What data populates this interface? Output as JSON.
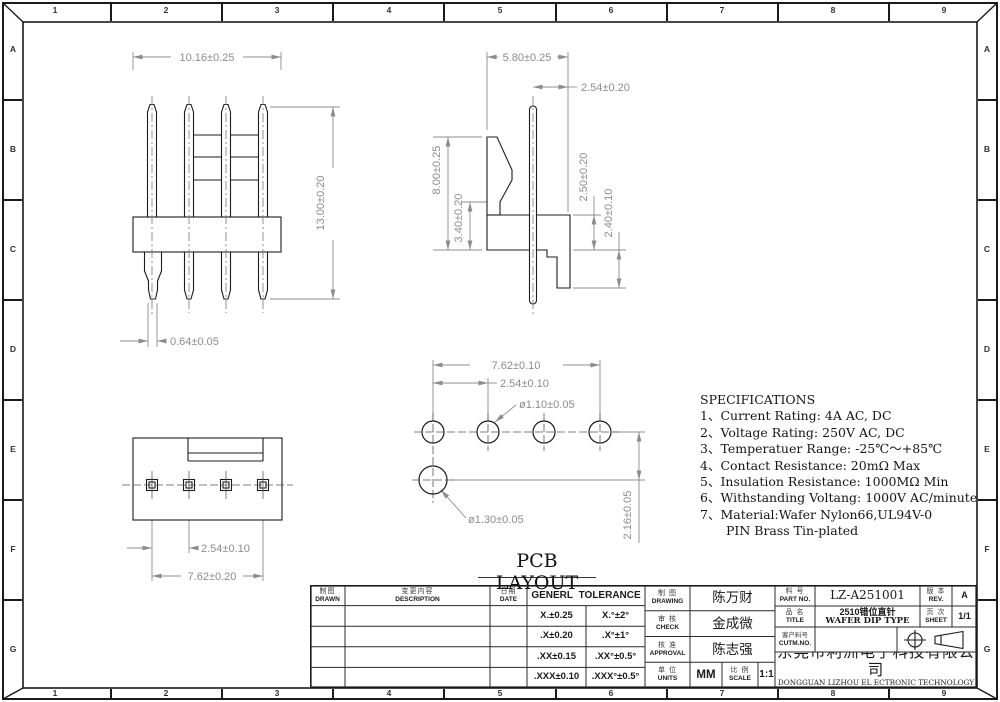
{
  "frame": {
    "cols": [
      "1",
      "2",
      "3",
      "4",
      "5",
      "6",
      "7",
      "8",
      "9"
    ],
    "rows": [
      "A",
      "B",
      "C",
      "D",
      "E",
      "F",
      "G"
    ]
  },
  "views": {
    "front": {
      "dim_width": "10.16±0.25",
      "dim_height": "13.00±0.20",
      "dim_pin_width": "0.64±0.05"
    },
    "side": {
      "dim_width": "5.80±0.25",
      "dim_pin_offset": "2.54±0.20",
      "dim_height": "8.00±0.25",
      "dim_body_height": "3.40±0.20",
      "dim_base_height": "2.50±0.20",
      "dim_foot_height": "2.40±0.10"
    },
    "bottom": {
      "dim_pitch": "2.54±0.10",
      "dim_span": "7.62±0.20"
    },
    "pcb": {
      "caption": "PCB LAYOUT",
      "dim_span": "7.62±0.10",
      "dim_pitch": "2.54±0.10",
      "dim_hole": "ø1.10±0.05",
      "dim_hole_offset": "ø1.30±0.05",
      "dim_row_offset": "2.16±0.05"
    }
  },
  "specs": {
    "title": "SPECIFICATIONS",
    "items": [
      "1、Current Rating: 4A AC, DC",
      "2、Voltage Rating: 250V AC, DC",
      "3、Temperatuer Range: -25℃～+85℃",
      "4、Contact Resistance: 20mΩ Max",
      "5、Insulation Resistance: 1000MΩ Min",
      "6、Withstanding Voltang: 1000V AC/minute",
      "7、Material:Wafer Nylon66,UL94V-0",
      "PIN Brass Tin-plated"
    ]
  },
  "title_block": {
    "drawn": {
      "cn": "制图",
      "en": "DRAWN"
    },
    "description": {
      "cn": "变更内容",
      "en": "DESCRIPTION"
    },
    "date": {
      "cn": "日期",
      "en": "DATE"
    },
    "tolerance": {
      "title": "GENERL TOLERANCE",
      "rows": [
        [
          "X.±0.25",
          "X.°±2°"
        ],
        [
          ".X±0.20",
          ".X°±1°"
        ],
        [
          ".XX±0.15",
          ".XX°±0.5°"
        ],
        [
          ".XXX±0.10",
          ".XXX°±0.5°"
        ]
      ]
    },
    "drawing": {
      "cn": "制 图",
      "en": "DRAWING",
      "value": "陈万财"
    },
    "check": {
      "cn": "审 核",
      "en": "CHECK",
      "value": "金成微"
    },
    "approval": {
      "cn": "核 准",
      "en": "APPROVAL",
      "value": "陈志强"
    },
    "units": {
      "cn": "单 位",
      "en": "UNITS",
      "value": "MM"
    },
    "scale": {
      "cn": "比 例",
      "en": "SCALE",
      "value": "1:1"
    },
    "part_no": {
      "cn": "料 号",
      "en": "PART NO.",
      "value": "LZ-A251001"
    },
    "product": {
      "cn": "品 名",
      "en": "TITLE",
      "value_cn": "2510错位直针",
      "value_en": "WAFER DIP TYPE"
    },
    "customer_no": {
      "cn": "客户料号",
      "en": "CUTM.NO.",
      "value": ""
    },
    "rev": {
      "cn": "版 本",
      "en": "REV.",
      "value": "A"
    },
    "sheet": {
      "cn": "页 次",
      "en": "SHEET",
      "value": "1/1"
    },
    "company_cn": "东莞市利洲电子科技有限公司",
    "company_en": "DONGGUAN LIZHOU EL ECTRONIC TECHNOLOGY CO.,LID"
  }
}
